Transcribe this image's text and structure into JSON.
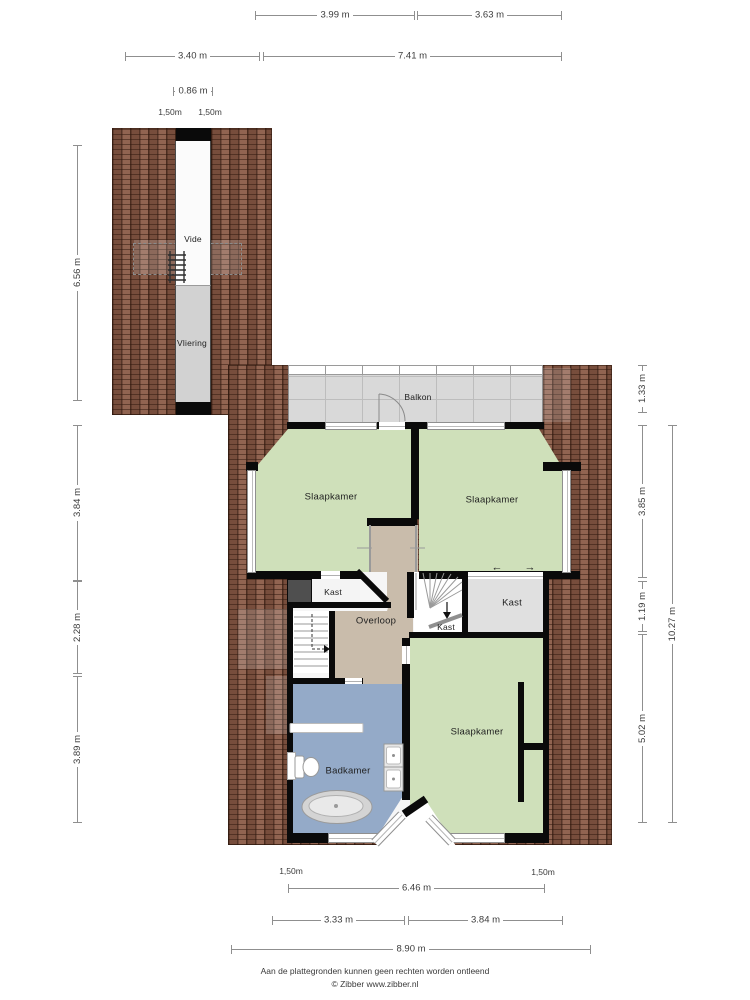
{
  "rooms": {
    "vide": "Vide",
    "vliering": "Vliering",
    "balkon": "Balkon",
    "bedroom_top_left": "Slaapkamer",
    "bedroom_top_right": "Slaapkamer",
    "bedroom_bottom": "Slaapkamer",
    "bathroom": "Badkamer",
    "landing": "Overloop",
    "closet_left": "Kast",
    "closet_under_stairs": "Kast",
    "closet_right": "Kast"
  },
  "dims": {
    "top1": "3.99 m",
    "top2": "3.63 m",
    "top3": "3.40 m",
    "top4": "7.41 m",
    "vide_w": "0.86 m",
    "head_l": "1,50m",
    "head_r": "1,50m",
    "left1": "6.56 m",
    "left2": "3.84 m",
    "left3": "2.28 m",
    "left4": "3.89 m",
    "right1": "1.33 m",
    "right2": "3.85 m",
    "right3": "1.19 m",
    "right4": "5.02 m",
    "right5": "10.27 m",
    "bot_head_l": "1,50m",
    "bot_head_r": "1,50m",
    "bot1": "6.46 m",
    "bot2": "3.33 m",
    "bot3": "3.84 m",
    "bot4": "8.90 m"
  },
  "symbols": {
    "slide_left": "←",
    "slide_right": "→"
  },
  "footer": {
    "line1": "Aan de plattegronden kunnen geen rechten worden ontleend",
    "line2": "© Zibber www.zibber.nl"
  },
  "colors": {
    "roof_brown": "#8a5a46",
    "bedroom_green": "#cfe0ba",
    "bathroom_blue": "#94aac8",
    "landing_tan": "#c9bcab",
    "balcony_gray": "#d9d9d9",
    "vliering_gray": "#d2d2d2",
    "closet_gray": "#e0e0e0",
    "shaft_gray": "#4f4f4f",
    "wall_black": "#0a0a0a",
    "dim_gray": "#8f8f8f"
  }
}
